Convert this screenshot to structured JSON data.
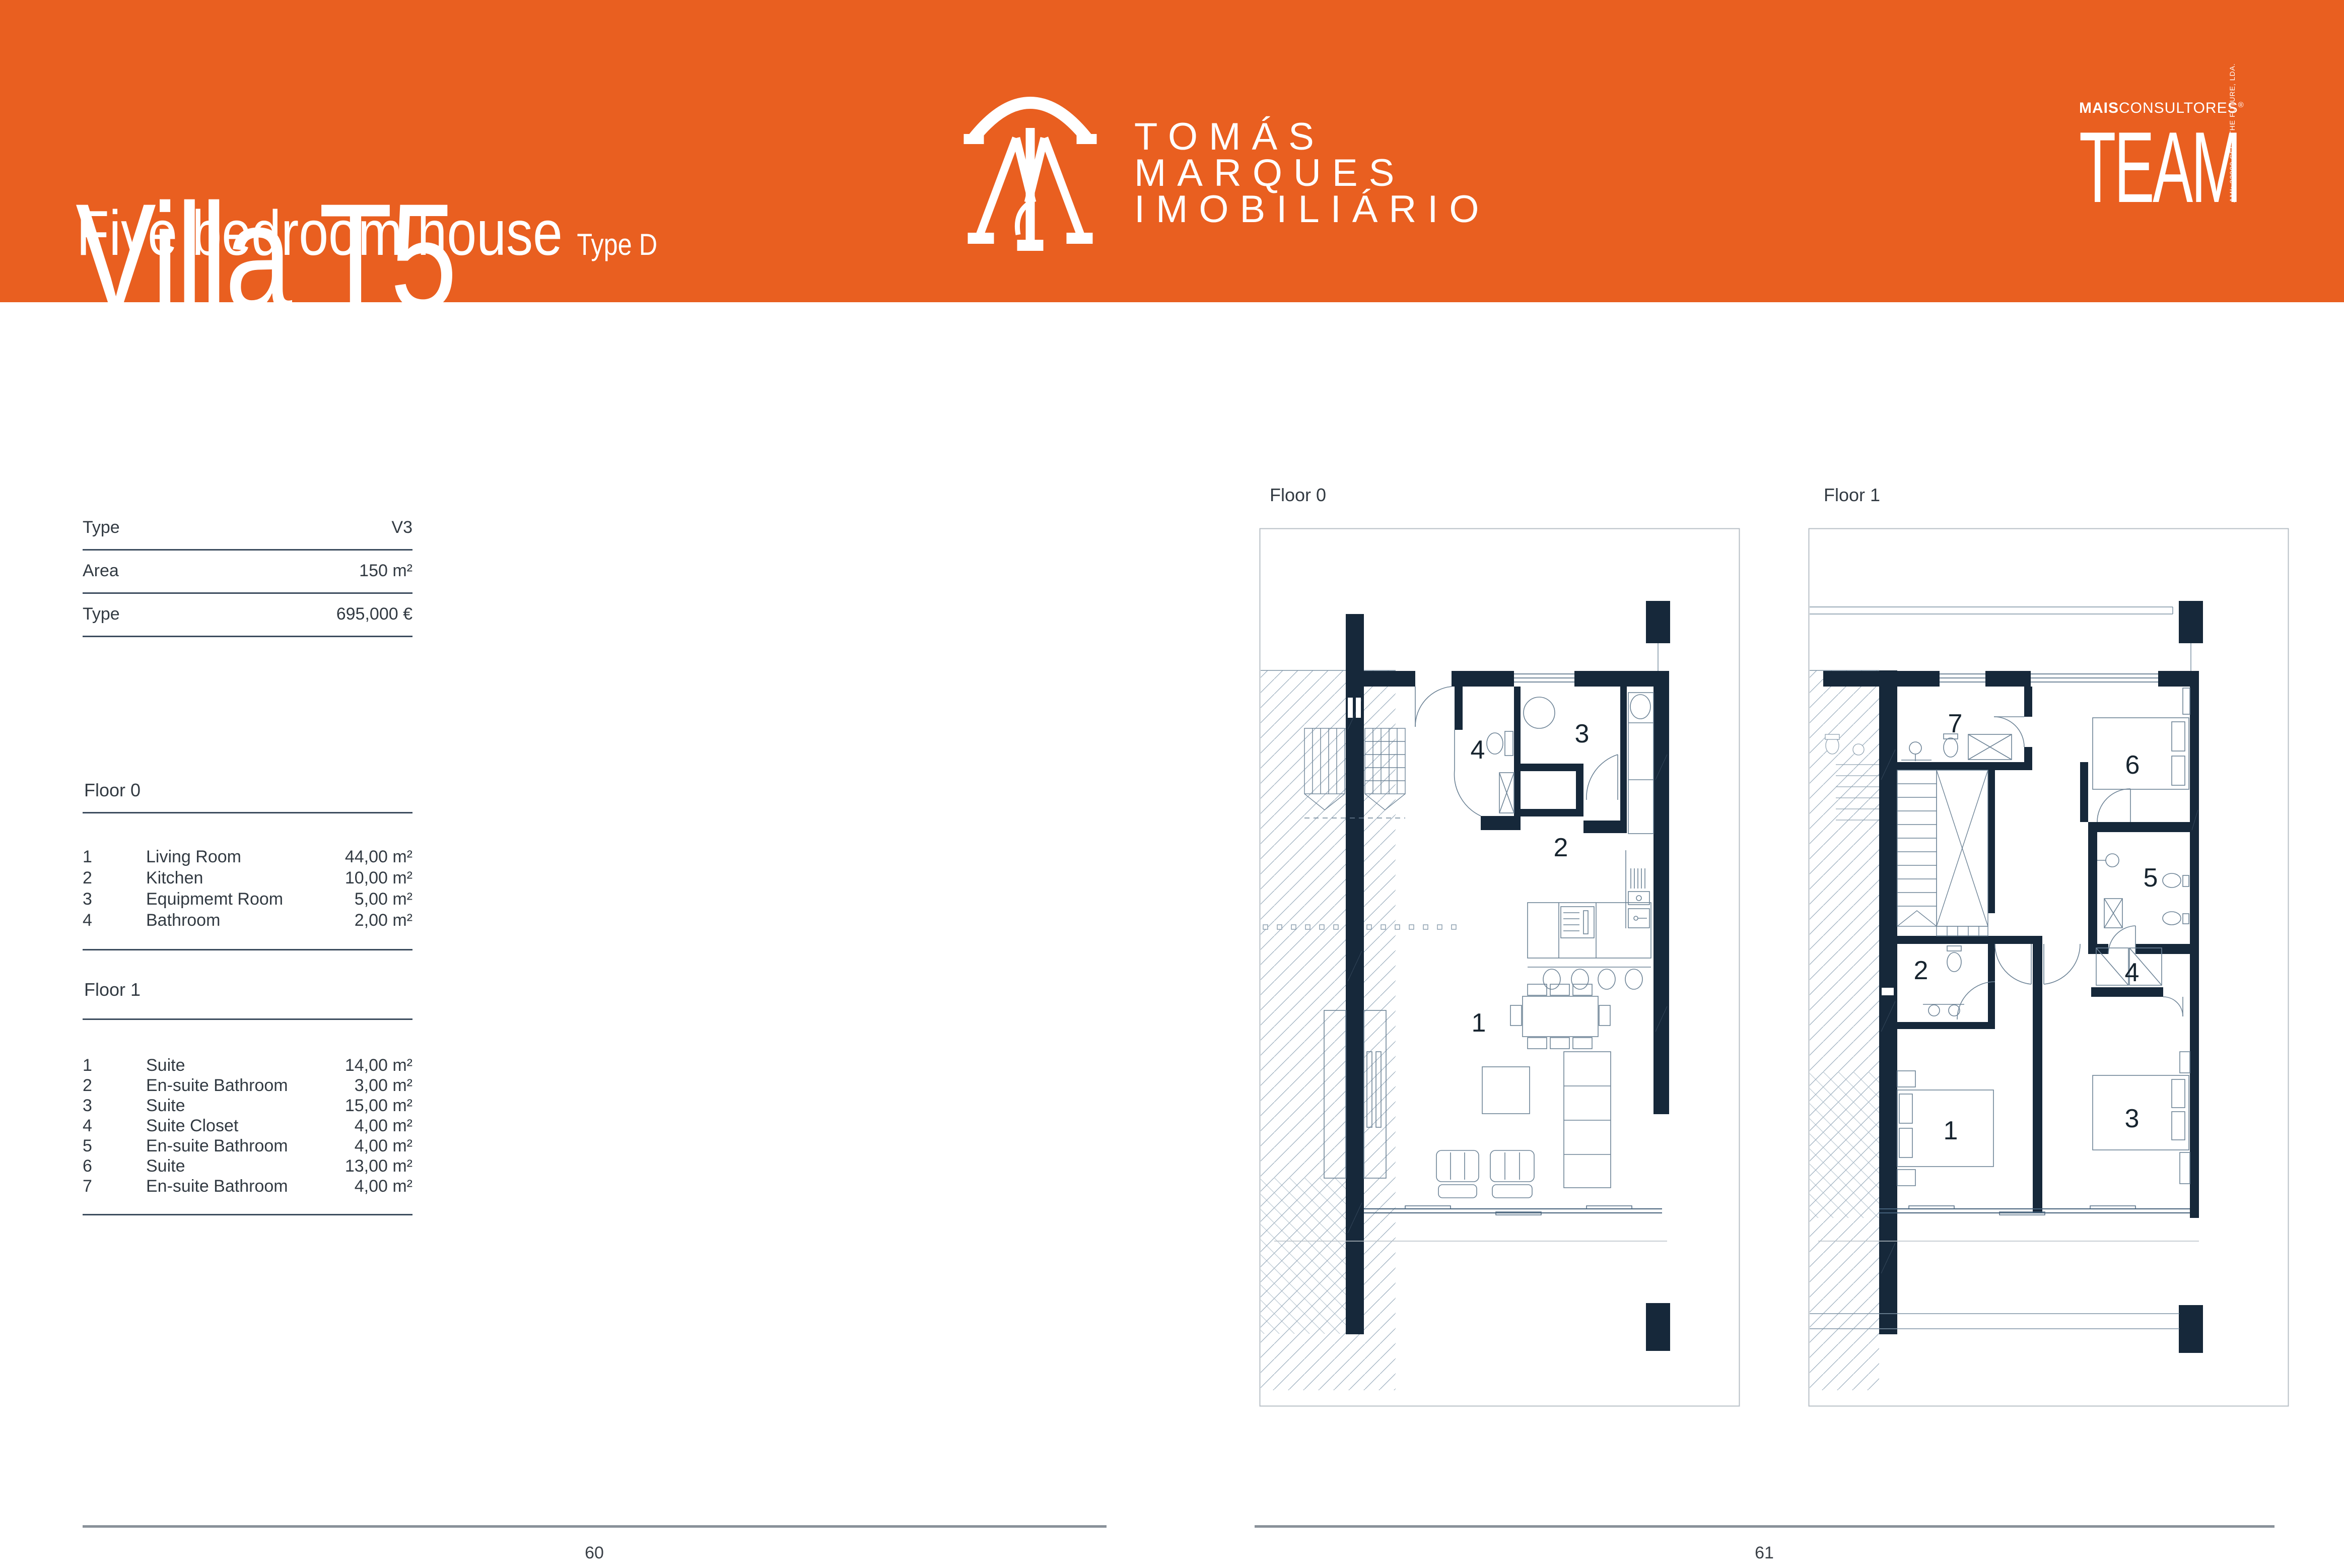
{
  "header": {
    "title": "Villa T5",
    "subtitle": "Five bedroom house",
    "type_tag": "Type D",
    "brand": {
      "line1": "TOMÁS",
      "line2": "MARQUES",
      "line3": "IMOBILIÁRIO"
    },
    "team": {
      "bold": "MAIS",
      "rest": "CONSULTORES",
      "reg": "®",
      "word": "TEAM",
      "side": "AMI: 23990  SEED THE FUTURE, LDA."
    }
  },
  "specs": {
    "rows": [
      {
        "label": "Type",
        "value": "V3"
      },
      {
        "label": "Area",
        "value": "150 m²"
      },
      {
        "label": "Type",
        "value": "695,000 €"
      }
    ]
  },
  "floor0": {
    "heading": "Floor 0",
    "rooms": [
      {
        "n": "1",
        "name": "Living Room",
        "area": "44,00 m²"
      },
      {
        "n": "2",
        "name": "Kitchen",
        "area": "10,00 m²"
      },
      {
        "n": "3",
        "name": "Equipmemt Room",
        "area": "5,00 m²"
      },
      {
        "n": "4",
        "name": "Bathroom",
        "area": "2,00 m²"
      }
    ]
  },
  "floor1": {
    "heading": "Floor 1",
    "rooms": [
      {
        "n": "1",
        "name": "Suite",
        "area": "14,00 m²"
      },
      {
        "n": "2",
        "name": "En-suite Bathroom",
        "area": "3,00 m²"
      },
      {
        "n": "3",
        "name": "Suite",
        "area": "15,00 m²"
      },
      {
        "n": "4",
        "name": "Suite Closet",
        "area": "4,00 m²"
      },
      {
        "n": "5",
        "name": "En-suite Bathroom",
        "area": "4,00 m²"
      },
      {
        "n": "6",
        "name": "Suite",
        "area": "13,00 m²"
      },
      {
        "n": "7",
        "name": "En-suite Bathroom",
        "area": "4,00 m²"
      }
    ]
  },
  "plans": {
    "floor0": {
      "label": "Floor 0",
      "rooms": {
        "r1": "1",
        "r2": "2",
        "r3": "3",
        "r4": "4"
      }
    },
    "floor1": {
      "label": "Floor 1",
      "rooms": {
        "r1": "1",
        "r2": "2",
        "r3": "3",
        "r4": "4",
        "r5": "5",
        "r6": "6",
        "r7": "7"
      }
    }
  },
  "footer": {
    "left_page": "60",
    "right_page": "61"
  },
  "colors": {
    "orange": "#E95F20",
    "navy": "#16283A",
    "rule": "#3c4c5e",
    "thin": "#7d92a4",
    "footer_line": "#899199"
  }
}
